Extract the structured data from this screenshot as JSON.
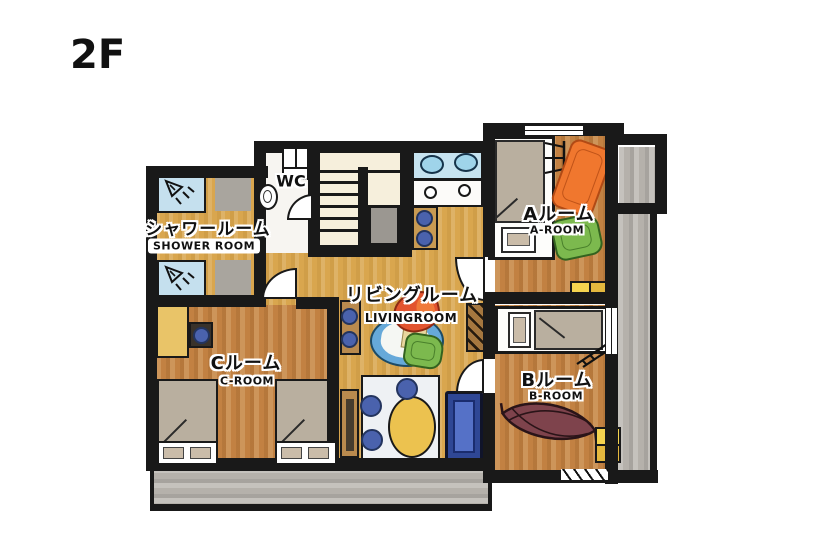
{
  "floor_label": "2F",
  "rooms": {
    "shower": {
      "label_jp": "シャワールーム",
      "label_en": "SHOWER ROOM"
    },
    "wc": {
      "label": "WC"
    },
    "living": {
      "label_jp": "リビングルーム",
      "label_en": "LIVINGROOM"
    },
    "room_a": {
      "label_jp": "Aルーム",
      "label_en": "A-ROOM"
    },
    "room_b": {
      "label_jp": "Bルーム",
      "label_en": "B-ROOM"
    },
    "room_c": {
      "label_jp": "Cルーム",
      "label_en": "C-ROOM"
    }
  },
  "colors": {
    "wall": "#191919",
    "floor_gold": "#d9a64e",
    "floor_wood": "#c28142",
    "floor_stairs": "#f6efdc",
    "floor_wc": "#f7f5f1",
    "balcony_gray": "#b5b1ab",
    "shower_blue": "#c5e0ee",
    "mat_gray": "#a9a59e",
    "counter_blue": "#c6e3f0",
    "sink_blue": "#9fd4ea",
    "accent_blue": "#4a62ad",
    "sofa_navy": "#2f4795",
    "sofa_seat": "#5571c7",
    "cushion_yellow": "#ecc24f",
    "futon_orange": "#f0772e",
    "cushion_green": "#7cb94e",
    "hammock_maroon": "#7e434c",
    "bench_brown": "#b98a4e",
    "bed_gray": "#b9af9f",
    "pillow_beige": "#cabca9",
    "table_round_blue": "#66a9d9"
  }
}
